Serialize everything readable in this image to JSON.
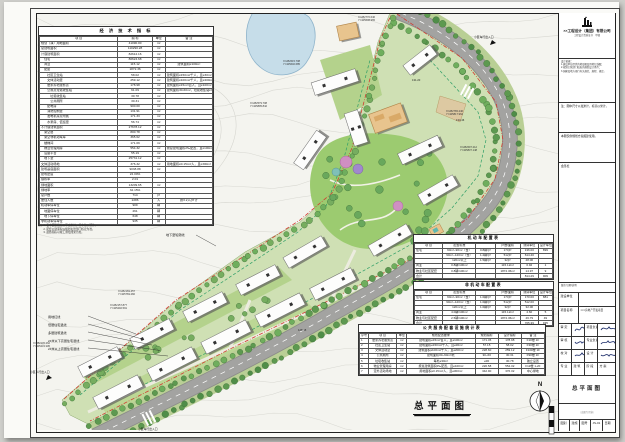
{
  "econ": {
    "title": "经 济 技 术 指 标",
    "headers": [
      "项  目",
      "指  标",
      "单位",
      "备  注"
    ],
    "rows": [
      [
        "规划（净）用地面积",
        "41090.00",
        "m²",
        ""
      ],
      [
        "总建筑面积",
        "110290.28",
        "m²",
        ""
      ],
      [
        "计容建筑面积",
        "82612.16",
        "m²",
        ""
      ],
      [
        "　住宅",
        "80624.68",
        "m²",
        ""
      ],
      [
        "　商业",
        "115.12",
        "m²",
        "建筑面积≥100m²"
      ],
      [
        "　配套",
        "1872.36",
        "m²",
        ""
      ],
      [
        "　　社区卫生站",
        "58.02",
        "m²",
        "建筑面积≥150m²/千人，且≥30m²"
      ],
      [
        "　　文体活动室",
        "259.12",
        "m²",
        "建筑面积≥100m²/千人，且≥200m²"
      ],
      [
        "　　居家养老服务点",
        "178.98",
        "m²",
        "建筑面积≥15m²/百人，且≥100m²"
      ],
      [
        "　　公厕及垃圾收集站",
        "61.09",
        "m²",
        "建筑面积30-60m²，垃圾收集站≥30m²"
      ],
      [
        "　　　垃圾收集站",
        "30.78",
        "m²",
        ""
      ],
      [
        "　　　公共厕所",
        "30.31",
        "m²",
        ""
      ],
      [
        "　　配电房",
        "900.00",
        "m²",
        ""
      ],
      [
        "　　消防控制室",
        "131.91",
        "m²",
        ""
      ],
      [
        "　　发电机房及附属",
        "171.33",
        "m²",
        ""
      ],
      [
        "　　水泵房、值班室",
        "56.74",
        "m²",
        ""
      ],
      [
        "不计容建筑面积",
        "27678.12",
        "m²",
        ""
      ],
      [
        "　架空层",
        "800.78",
        "m²",
        ""
      ],
      [
        "　架空非机动车库",
        "365.62",
        "m²",
        ""
      ],
      [
        "　楼梯间",
        "171.09",
        "m²",
        ""
      ],
      [
        "　物业管理用房",
        "554.32",
        "m²",
        "按总建筑面积2‰配置，且≥100m²"
      ],
      [
        "　设备平台",
        "55.19",
        "m²",
        ""
      ],
      [
        "　地下室",
        "25731.12",
        "m²",
        ""
      ],
      [
        "文体活动场地",
        "376.32",
        "m²",
        "用地面积≥0.15m²/人，且≥300m²"
      ],
      [
        "建筑基底面积",
        "9038.88",
        "m²",
        ""
      ],
      [
        "建筑密度",
        "22.00%",
        "",
        ""
      ],
      [
        "容积率",
        "2.01",
        "",
        ""
      ],
      [
        "绿地面积",
        "13209.65",
        "m²",
        ""
      ],
      [
        "绿地率",
        "32.15%",
        "",
        ""
      ],
      [
        "总户数",
        "714",
        "户",
        ""
      ],
      [
        "居住人数",
        "2286",
        "人",
        "按3.2人/户计"
      ],
      [
        "机动车停车位",
        "909",
        "辆",
        ""
      ],
      [
        "　地面停车位",
        "261",
        "辆",
        ""
      ],
      [
        "　地下停车位",
        "648",
        "辆",
        ""
      ],
      [
        "非机动车停车位",
        "935",
        "辆",
        ""
      ]
    ],
    "notes": [
      "注：1. 表中面积指标以平方米计，停车位以辆计。",
      "　　2. 配套公建面积以规划主管部门核定为准。",
      "　　3. 最终指标以竣工测绘成果为准。"
    ]
  },
  "motor": {
    "title": "机动车配置表",
    "headers": [
      "项 目",
      "配置标准",
      "",
      "户数/面积",
      "测算车位",
      "设计车位"
    ],
    "rows": [
      [
        "住宅",
        "60m²~90m²（含）",
        "0.8辆/户",
        "170户",
        "136.00",
        "899"
      ],
      [
        "",
        "90m²~120m²（含）",
        "1.2辆/户",
        "512户",
        "614.40",
        ""
      ],
      [
        "",
        "120m²以上",
        "1.5辆/户",
        "32户",
        "48.00",
        ""
      ],
      [
        "商业",
        "0.8辆/100m²",
        "",
        "115.12m²",
        "0.92",
        "1"
      ],
      [
        "物业与社区配套",
        "0.8辆/100m²",
        "",
        "1872.36m²",
        "14.97",
        "9"
      ],
      [
        "合计",
        "",
        "",
        "",
        "814.29",
        "909"
      ]
    ]
  },
  "nonmotor": {
    "title": "非机动车配置表",
    "headers": [
      "项 目",
      "配置标准",
      "",
      "户数/面积",
      "测算车位",
      "设计车位"
    ],
    "rows": [
      [
        "住宅",
        "60m²~90m²（含）",
        "1.0辆/户",
        "170户",
        "170.00",
        "881"
      ],
      [
        "",
        "90m²~120m²（含）",
        "1.0辆/户",
        "512户",
        "512.00",
        ""
      ],
      [
        "",
        "120m²以上",
        "1.0辆/户",
        "32户",
        "32.00",
        ""
      ],
      [
        "商业",
        "4.0辆/100m²",
        "",
        "115.12m²",
        "4.60",
        "5"
      ],
      [
        "物业与社区配套",
        "2.5辆/100m²",
        "",
        "1872.36m²",
        "46.79",
        "49"
      ],
      [
        "合计",
        "",
        "",
        "",
        "765.39",
        "935"
      ]
    ]
  },
  "public": {
    "title": "公共服务配套设施统计表",
    "headers": [
      "序号",
      "项 目",
      "单位",
      "规划配置要求",
      "规划指标",
      "设计指标",
      "备 注"
    ],
    "rows": [
      [
        "1",
        "居家养老服务点",
        "m²",
        "建筑面积≥15m²/百人，且≥100m²",
        "171.45",
        "178.98",
        "F1#楼 1F"
      ],
      [
        "2",
        "社区卫生站",
        "m²",
        "建筑面积≥150m²/千人，且≥30m²",
        "57.15",
        "58.02",
        "F3#楼 1F"
      ],
      [
        "3",
        "文体活动室",
        "m²",
        "建筑面积≥100m²/千人，且≥200m²",
        "228.60",
        "259.12",
        "F10#楼 1F"
      ],
      [
        "4",
        "公共厕所",
        "m²",
        "建筑面积30~60m²/处",
        "30~60",
        "30.31",
        "F9#楼 1F"
      ],
      [
        "5",
        "垃圾收集站",
        "m²",
        "每处≥30m²",
        "≥30",
        "30.78",
        "独立设置"
      ],
      [
        "6",
        "物业管理用房",
        "m²",
        "按总建筑面积2‰配置，且≥100m²",
        "220.58",
        "554.32",
        "F1#楼 1-2F"
      ],
      [
        "7",
        "室外活动场地",
        "m²",
        "用地面积≥0.15m²/人，且≥300m²",
        "342.90",
        "376.32",
        "中心绿地"
      ]
    ]
  },
  "plan": {
    "title": "总平面图",
    "north": "N",
    "basement_label": "地下室轮廓线",
    "callouts": [
      "用地红线",
      "低层住宅退线",
      "多层建筑退线",
      "24米以下高层住宅退线",
      "24米以上高层住宅退线"
    ],
    "coords": [
      {
        "x": 283,
        "y": 60,
        "l1": "X=282615.708",
        "l2": "Y=425640.685"
      },
      {
        "x": 250,
        "y": 102,
        "l1": "X=282579.708",
        "l2": "Y=425895.842"
      },
      {
        "x": 118,
        "y": 290,
        "l1": "X=282169.457",
        "l2": "Y=425769.282"
      },
      {
        "x": 110,
        "y": 304,
        "l1": "X=282157.877",
        "l2": "Y=425292.591"
      },
      {
        "x": 33,
        "y": 342,
        "l1": "X=282145.262",
        "l2": "Y=425231.105"
      },
      {
        "x": 446,
        "y": 110,
        "l1": "X=282765.246",
        "l2": "Y=425817.962"
      },
      {
        "x": 460,
        "y": 146,
        "l1": "X=282697.212",
        "l2": "Y=425837.148"
      },
      {
        "x": 358,
        "y": 16,
        "l1": "X=282770.646",
        "l2": "Y=425638.965"
      }
    ],
    "entrances": [
      {
        "x": 474,
        "y": 35,
        "t": "小区车行出入口"
      },
      {
        "x": 30,
        "y": 370,
        "t": "小区人行出入口"
      },
      {
        "x": 138,
        "y": 427,
        "t": "小区车行出入口"
      }
    ],
    "spots": [
      {
        "x": 456,
        "y": 119,
        "t": "134.46"
      },
      {
        "x": 412,
        "y": 79,
        "t": "131.20"
      },
      {
        "x": 298,
        "y": 329,
        "t": "128.35"
      }
    ]
  },
  "titleblock": {
    "company": "××工程设计（集团）有限公司",
    "cert": "工程设计资质证书　甲级",
    "basis_title": "设计依据：",
    "basis": [
      "1.建设单位提供的地形图及用地红线图；",
      "2.规划主管部门核发的规划设计条件；",
      "3.国家及地方现行有关规范、规程、规定。"
    ],
    "note1": "注：图中尺寸以毫米计，标高以米计。",
    "note2": "本图仅供规划方案报建使用。",
    "hui": "会签栏",
    "rev": "版次/日期/说明",
    "owner_label": "建设单位",
    "project_label": "项目名称",
    "project_value": "×××房地产开发项目",
    "shending": "审 定",
    "xiangmufuze": "项目负责",
    "shenhe": "审 核",
    "zhuanyefuze": "专业负责",
    "jiaodui": "校 对",
    "sheji": "设 计",
    "zhuanye_label": "专 业",
    "zhuanye_value": "建 筑",
    "jieduan_label": "阶 段",
    "jieduan_value": "方 案",
    "drawing_label": "图 名",
    "drawing_value": "总平面图",
    "stamp": "（出图专用章）",
    "tubie_label": "图别",
    "tubie_value": "建施",
    "tuhao_label": "图号",
    "tuhao_value": "JS-01",
    "riqi_label": "日期",
    "riqi_value": ""
  }
}
